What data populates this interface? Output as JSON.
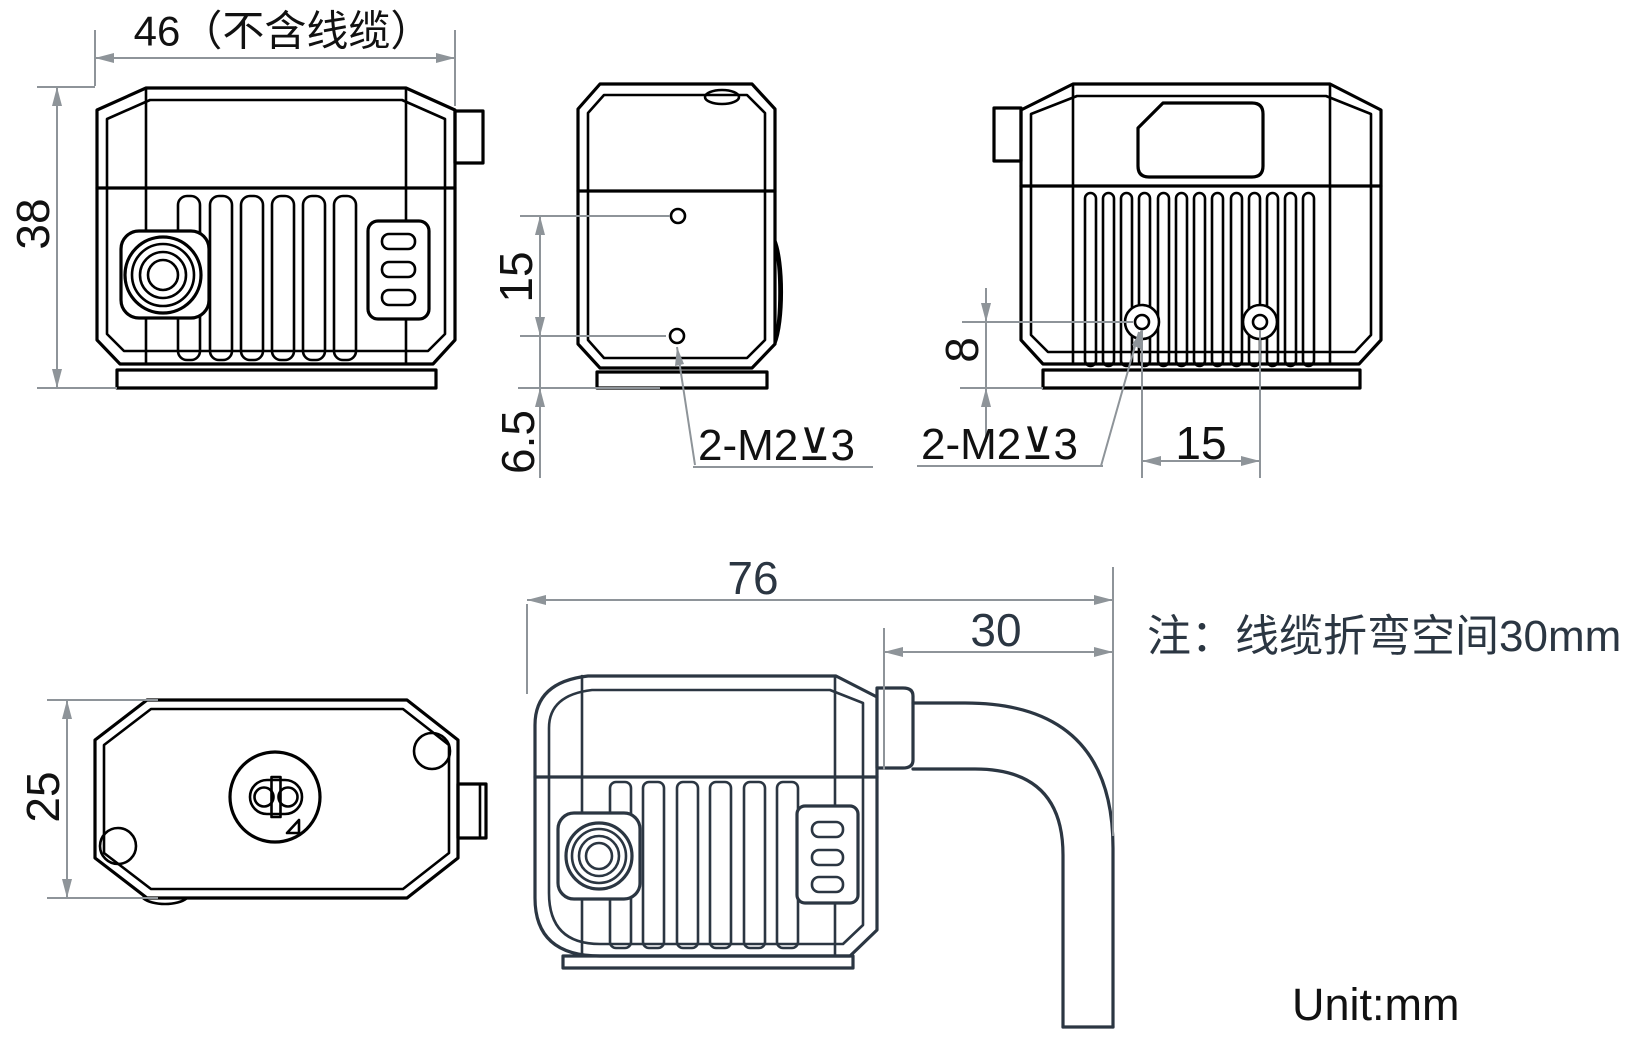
{
  "drawing": {
    "note": "注：线缆折弯空间30mm",
    "unit_label": "Unit:mm"
  },
  "front_view": {
    "width_label": "46（不含线缆）",
    "height_label": "38"
  },
  "side_view": {
    "hole_spacing_label": "15",
    "bottom_offset_label": "6.5",
    "thread_callout": "2-M2⊻3"
  },
  "rear_view": {
    "hole_height_label": "8",
    "hole_spacing_label": "15",
    "thread_callout": "2-M2⊻3"
  },
  "top_view": {
    "depth_label": "25"
  },
  "cable_view": {
    "overall_length_label": "76",
    "bend_space_label": "30"
  },
  "colors": {
    "line": "#000000",
    "cable_view_line": "#2b3642",
    "dimension": "#8e9499",
    "background": "#ffffff"
  }
}
